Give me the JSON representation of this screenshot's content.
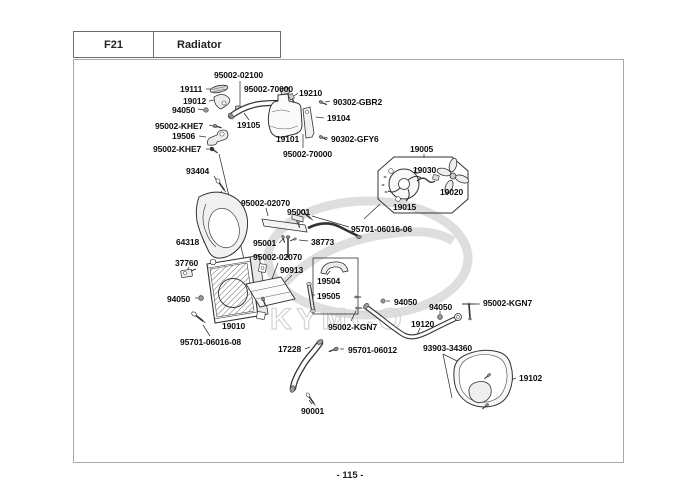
{
  "header": {
    "code": "F21",
    "title": "Radiator"
  },
  "page_number": "- 115 -",
  "watermark": "KYMCO",
  "labels": [
    "95002-02100",
    "19111",
    "95002-70000",
    "19210",
    "90302-GBR2",
    "19012",
    "94050",
    "95002-KHE7",
    "19105",
    "19104",
    "19506",
    "90302-GFY6",
    "19101",
    "95002-KHE7",
    "95002-70000",
    "19005",
    "93404",
    "19030",
    "19020",
    "95002-02070",
    "95001",
    "19015",
    "95701-06016-06",
    "64318",
    "95001",
    "38773",
    "37760",
    "95002-02070",
    "90913",
    "19504",
    "94050",
    "19505",
    "94050",
    "94050",
    "95002-KGN7",
    "19010",
    "19120",
    "95002-KGN7",
    "95701-06016-08",
    "17228",
    "95701-06012",
    "93903-34360",
    "19102",
    "90001"
  ]
}
